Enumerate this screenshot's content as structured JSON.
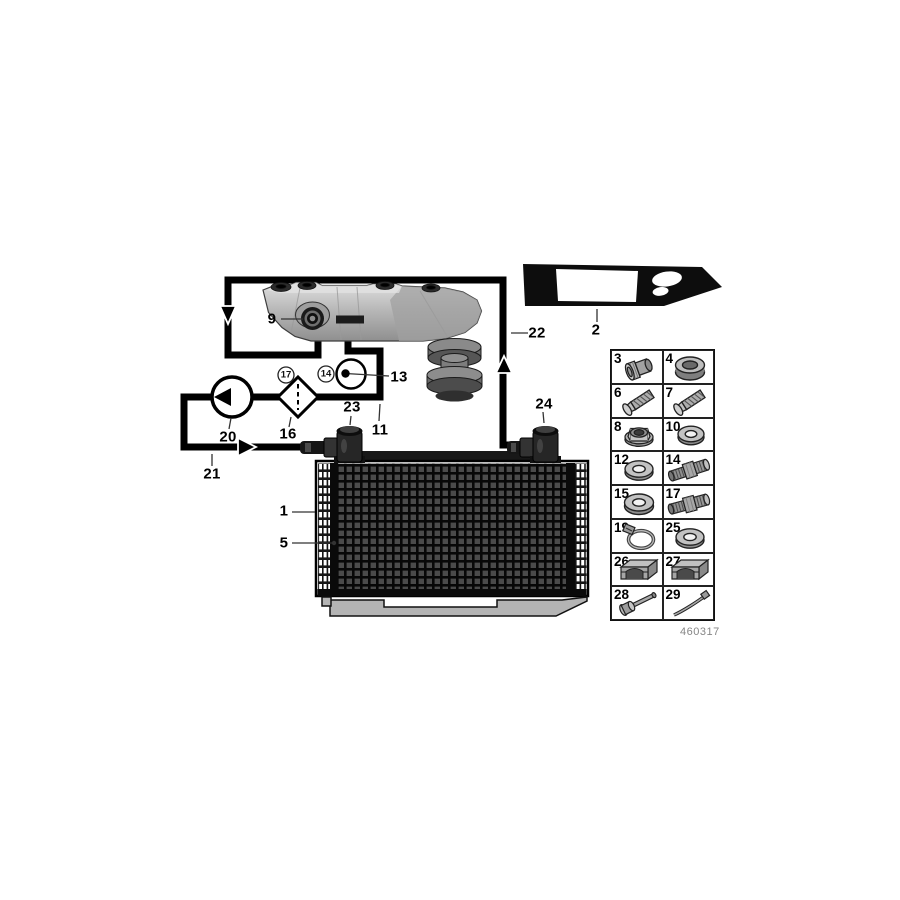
{
  "figure": {
    "code": "460317"
  },
  "colors": {
    "line_black": "#000000",
    "panel_black": "#0d0d0d",
    "pan_gray": "#bdbdbd",
    "core_cell_gray": "#4a4a4a",
    "tray_gray": "#b4b4b4",
    "figure_code_gray": "#868686"
  },
  "diagram": {
    "symbols": [
      "oil-pump",
      "oil-filter",
      "temperature-sensor"
    ],
    "flow_arrows": [
      "down",
      "right",
      "up"
    ],
    "callouts": [
      {
        "id": "9",
        "text": "9"
      },
      {
        "id": "2",
        "text": "2"
      },
      {
        "id": "22",
        "text": "22"
      },
      {
        "id": "13",
        "text": "13"
      },
      {
        "id": "17",
        "text": "17",
        "circled": true
      },
      {
        "id": "14",
        "text": "14",
        "circled": true
      },
      {
        "id": "16",
        "text": "16"
      },
      {
        "id": "20",
        "text": "20"
      },
      {
        "id": "23",
        "text": "23"
      },
      {
        "id": "11",
        "text": "11"
      },
      {
        "id": "21",
        "text": "21"
      },
      {
        "id": "24",
        "text": "24"
      },
      {
        "id": "1",
        "text": "1"
      },
      {
        "id": "5",
        "text": "5"
      }
    ]
  },
  "parts_table": {
    "cells": [
      {
        "number": "3",
        "icon": "sealing-plug"
      },
      {
        "number": "4",
        "icon": "grommet-ring"
      },
      {
        "number": "6",
        "icon": "screw"
      },
      {
        "number": "7",
        "icon": "screw"
      },
      {
        "number": "8",
        "icon": "flange-nut"
      },
      {
        "number": "10",
        "icon": "washer"
      },
      {
        "number": "12",
        "icon": "washer"
      },
      {
        "number": "14",
        "icon": "union-fitting"
      },
      {
        "number": "15",
        "icon": "washer"
      },
      {
        "number": "17",
        "icon": "union-fitting"
      },
      {
        "number": "19",
        "icon": "hose-clamp"
      },
      {
        "number": "25",
        "icon": "washer"
      },
      {
        "number": "26",
        "icon": "cable-clip"
      },
      {
        "number": "27",
        "icon": "cable-clip"
      },
      {
        "number": "28",
        "icon": "expansion-rivet"
      },
      {
        "number": "29",
        "icon": "cable-tie"
      }
    ]
  }
}
